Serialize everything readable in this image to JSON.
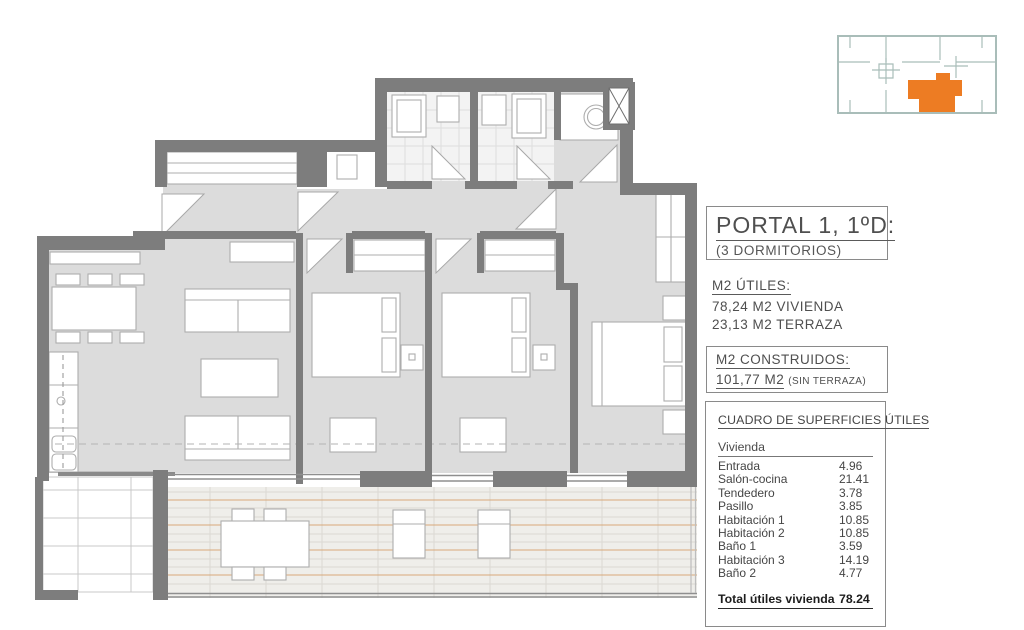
{
  "key_plan": {
    "description": "building key plan with current unit highlighted",
    "outline_color": "#a9bdb9",
    "highlight_color": "#ed7c23"
  },
  "title_block": {
    "title": "PORTAL 1, 1ºD:",
    "subtitle": "(3 DORMITORIOS)"
  },
  "areas_utiles": {
    "heading": "M2 ÚTILES:",
    "lines": [
      "78,24 M2 VIVIENDA",
      "23,13 M2 TERRAZA"
    ]
  },
  "areas_construidas": {
    "heading": "M2 CONSTRUIDOS:",
    "value": "101,77 M2",
    "note": "(SIN TERRAZA)"
  },
  "surface_table": {
    "title": "CUADRO DE SUPERFICIES ÚTILES",
    "group_header": "Vivienda",
    "rows": [
      {
        "label": "Entrada",
        "value": "4.96"
      },
      {
        "label": "Salón-cocina",
        "value": "21.41"
      },
      {
        "label": "Tendedero",
        "value": "3.78"
      },
      {
        "label": "Pasillo",
        "value": "3.85"
      },
      {
        "label": "Habitación 1",
        "value": "10.85"
      },
      {
        "label": "Habitación 2",
        "value": "10.85"
      },
      {
        "label": "Baño 1",
        "value": "3.59"
      },
      {
        "label": "Habitación 3",
        "value": "14.19"
      },
      {
        "label": "Baño 2",
        "value": "4.77"
      }
    ],
    "total_label": "Total útiles vivienda",
    "total_value": "78.24"
  },
  "plan_colors": {
    "wall": "#7d7d7d",
    "floor": "#dcdcdc",
    "terrace_accent": "#d8a87a"
  }
}
